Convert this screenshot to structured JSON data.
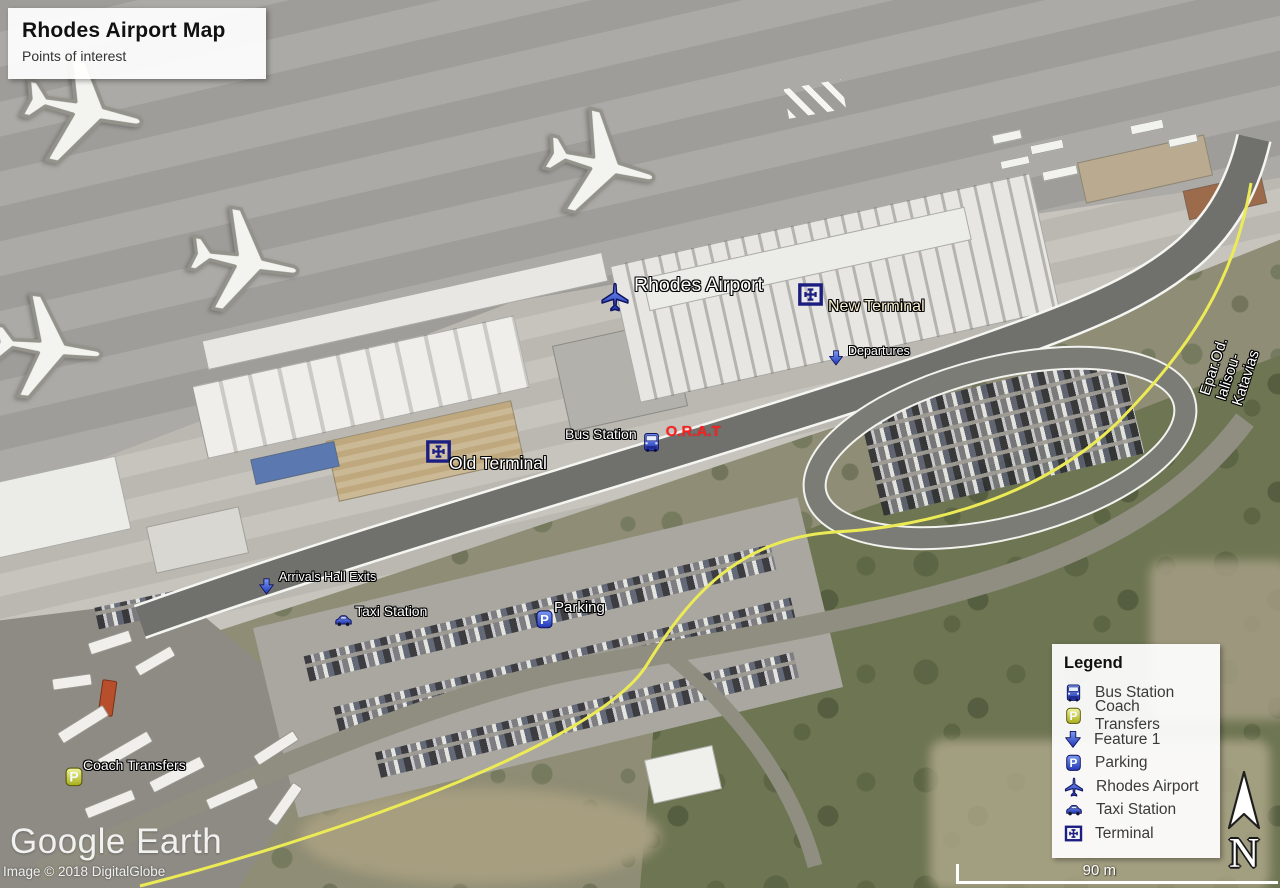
{
  "title_box": {
    "title": "Rhodes Airport Map",
    "subtitle": "Points of interest"
  },
  "placemarks": {
    "rhodes_airport": {
      "label": "Rhodes Airport",
      "icon": "airplane-icon"
    },
    "new_terminal": {
      "label": "New Terminal",
      "icon": "terminal-icon"
    },
    "departures": {
      "label": "Departures",
      "icon": "arrow-down-icon"
    },
    "bus_station": {
      "label": "Bus Station",
      "icon": "bus-icon"
    },
    "orat": {
      "label": "O.R.A.T",
      "color": "#ff1f1f"
    },
    "old_terminal": {
      "label": "Old Terminal",
      "icon": "terminal-icon"
    },
    "arrivals_hall_exits": {
      "label": "Arrivals Hall Exits",
      "icon": "arrow-down-icon"
    },
    "taxi_station": {
      "label": "Taxi Station",
      "icon": "taxi-icon"
    },
    "parking": {
      "label": "Parking",
      "icon": "parking-icon"
    },
    "coach_transfers": {
      "label": "Coach Transfers",
      "icon": "coach-parking-icon"
    }
  },
  "road_label": {
    "label": "Epar.Od. Ialisou-Katavias"
  },
  "legend": {
    "title": "Legend",
    "items": [
      {
        "icon": "bus-icon",
        "label": "Bus Station"
      },
      {
        "icon": "coach-parking-icon",
        "label": "Coach Transfers"
      },
      {
        "icon": "arrow-down-icon",
        "label": "Feature 1"
      },
      {
        "icon": "parking-icon",
        "label": "Parking"
      },
      {
        "icon": "airplane-icon",
        "label": "Rhodes Airport"
      },
      {
        "icon": "taxi-icon",
        "label": "Taxi Station"
      },
      {
        "icon": "terminal-icon",
        "label": "Terminal"
      }
    ]
  },
  "scale_bar": {
    "label": "90 m"
  },
  "compass": {
    "label": "N"
  },
  "watermark": {
    "logo": "Google Earth",
    "attribution": "Image © 2018 DigitalGlobe"
  },
  "colors": {
    "placemark_blue": "#2f4bd4",
    "placemark_navy_outline": "#10135f",
    "terminal_navy": "#1c1d80",
    "label_red": "#ff1f1f",
    "label_cream": "#f8f0d0",
    "boundary_yellow": "#eceb56",
    "coach_yellow": "#d9dc3f"
  }
}
